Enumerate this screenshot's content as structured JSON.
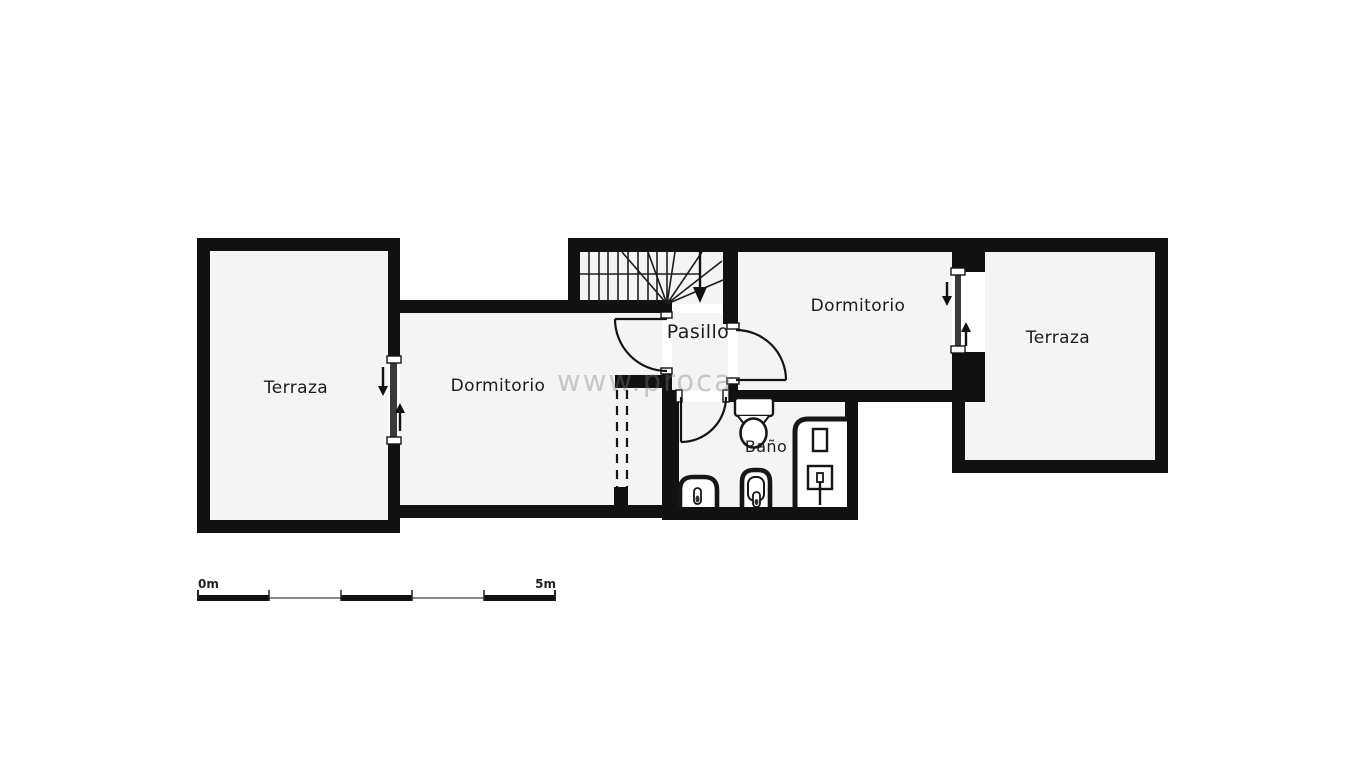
{
  "colors": {
    "background": "#ffffff",
    "wall": "#111111",
    "room_fill": "#f4f4f4",
    "watermark": "#7f7f7f"
  },
  "rooms": {
    "terraza_left": {
      "label": "Terraza"
    },
    "dormitorio_left": {
      "label": "Dormitorio"
    },
    "pasillo": {
      "label": "Pasillo"
    },
    "dormitorio_right": {
      "label": "Dormitorio"
    },
    "terraza_right": {
      "label": "Terraza"
    },
    "bano": {
      "label": "Baño"
    }
  },
  "fixtures": {
    "stairs": "staircase-with-winder-down-arrow",
    "wardrobe": "dashed-wardrobe",
    "toilet": "toilet",
    "bidet": "bidet",
    "washbasin": "washbasin",
    "shower": "shower-tray",
    "sliding_door_left": "sliding-door",
    "sliding_door_right": "sliding-door",
    "swing_doors": 3
  },
  "scale_bar": {
    "start_label": "0m",
    "end_label": "5m"
  },
  "watermark": {
    "text": "www.proca"
  }
}
